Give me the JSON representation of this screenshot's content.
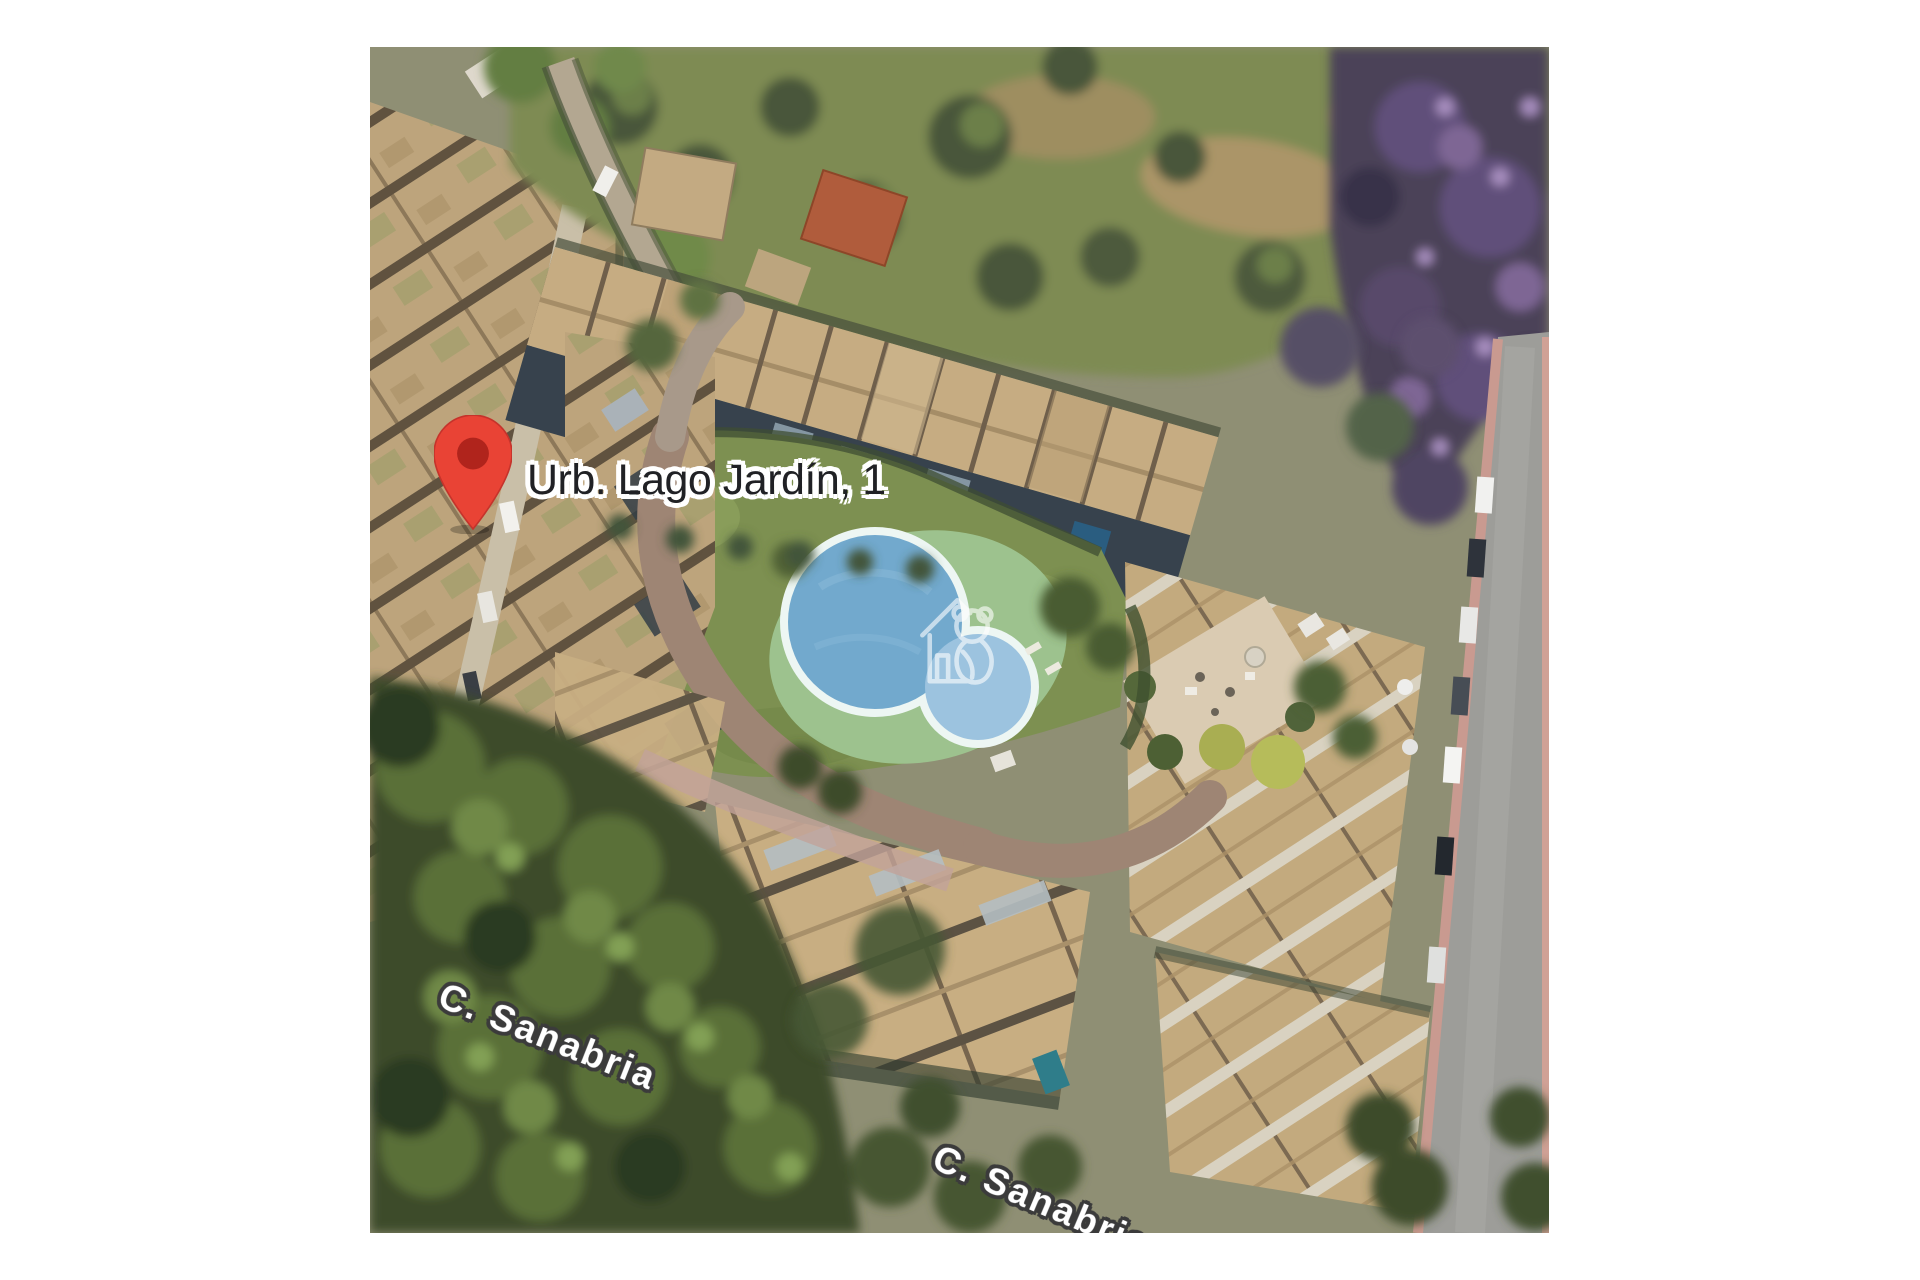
{
  "map": {
    "pin": {
      "label": "Urb. Lago Jardín, 1"
    },
    "street_labels": [
      {
        "text": "C. Sanabria"
      },
      {
        "text": "C. Sanabria"
      }
    ],
    "colors": {
      "pin_fill": "#E94335",
      "pin_stroke": "#C5332B",
      "pin_core": "#B0241C",
      "pin_label_text": "#202125",
      "pin_label_halo": "#FFFFFF",
      "street_label_text": "#FFFFFF",
      "street_label_halo": "#3B3B3B",
      "watermark": "#FFFFFF",
      "pool_water": "#72A9CD",
      "pool_water_light": "#9CC3DF",
      "pool_rim": "#EDF6F3",
      "pool_deck": "#9DC28E",
      "lawn": "#7D9051",
      "road": "#9D9D99",
      "forest": "#3D4C2C",
      "roof_straw": "#C6AC82"
    }
  }
}
